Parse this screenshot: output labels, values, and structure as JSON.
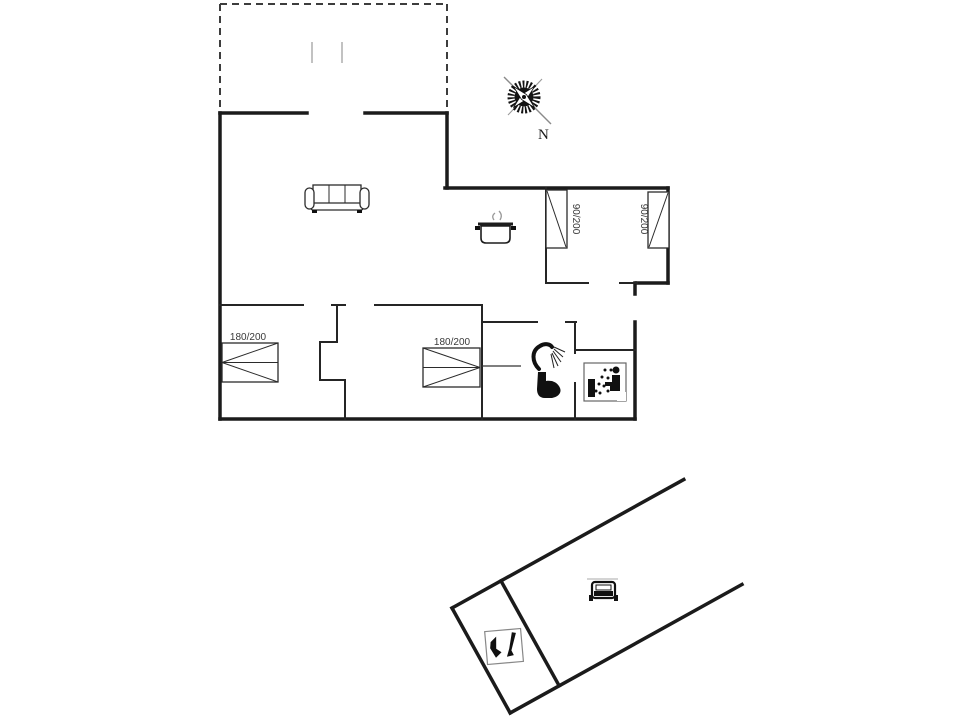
{
  "plan": {
    "type": "floor-plan",
    "labels": {
      "bed_double_left": "180/200",
      "bed_double_right": "180/200",
      "bed_single_left": "90/200",
      "bed_single_right": "90/200",
      "compass_north": "N"
    },
    "icons": [
      "compass-rose-icon",
      "sofa-icon",
      "cooking-pot-icon",
      "shower-icon",
      "toilet-icon",
      "sauna-icon",
      "car-icon",
      "garden-tools-icon"
    ],
    "colors": {
      "background": "#ffffff",
      "outer_wall": "#1b1b1b",
      "interior_wall": "#252525",
      "terrace_dashed": "#3d3d3d",
      "terrace_tick": "#b3b3b3",
      "label_text": "#3a3a3a",
      "icon_black": "#101010"
    }
  }
}
